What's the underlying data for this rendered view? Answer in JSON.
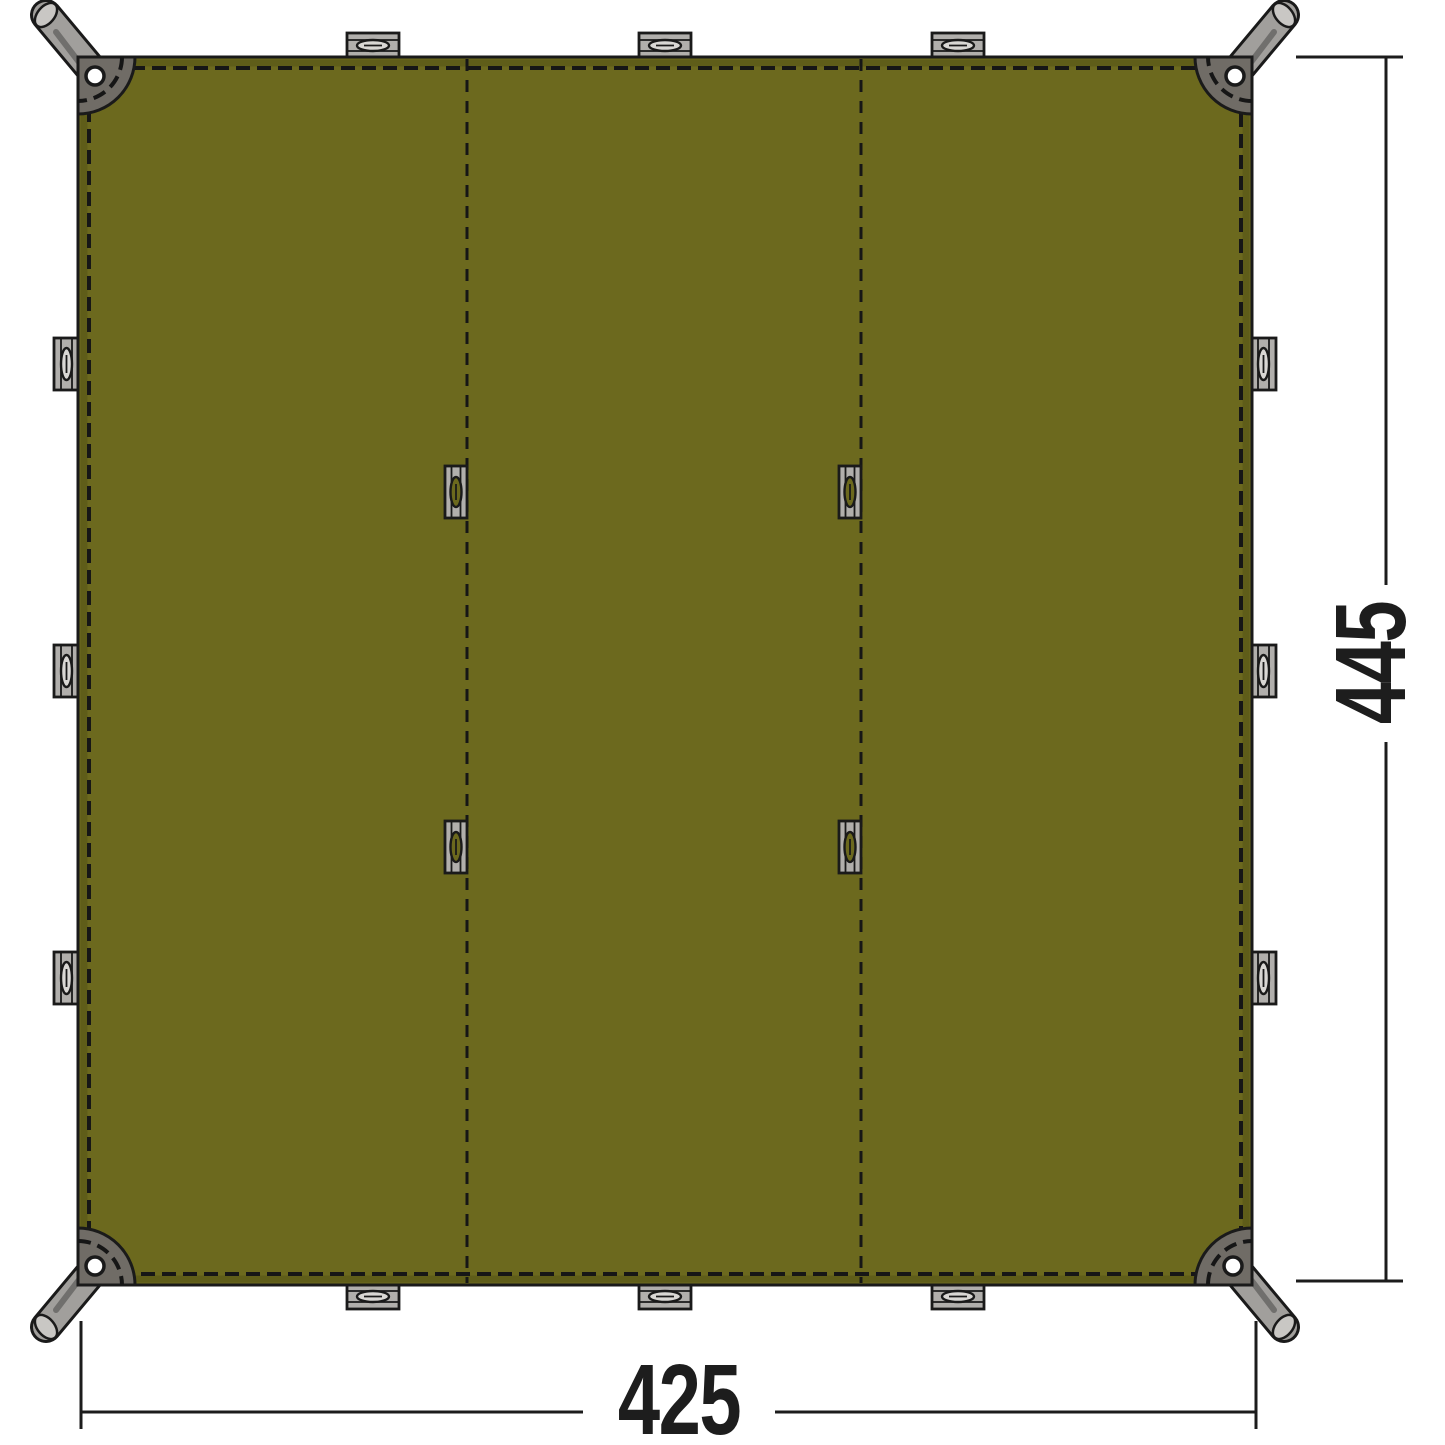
{
  "diagram": {
    "width_dimension": "425",
    "height_dimension": "445"
  },
  "features": {
    "fabric_panels": 3,
    "corner_patches": 4,
    "corner_grommets": 4,
    "corner_webbing_loops": 4,
    "edge_tabs_per_side": 3,
    "seam_loops": 4
  },
  "colors": {
    "background": "#ffffff",
    "tarp_olive": "#6c691e",
    "stitch_dark": "#161616",
    "outline_dark": "#1a1a1a",
    "patch_gray": "#706c66",
    "strap_gray": "#a19f9c",
    "strap_light": "#c9c7c4",
    "tab_gray": "#b1afac",
    "slot_light": "#d9d7d4",
    "grommet_white": "#ffffff",
    "dimension_line": "#1c1c1c",
    "label_text": "#1d1d1d"
  }
}
